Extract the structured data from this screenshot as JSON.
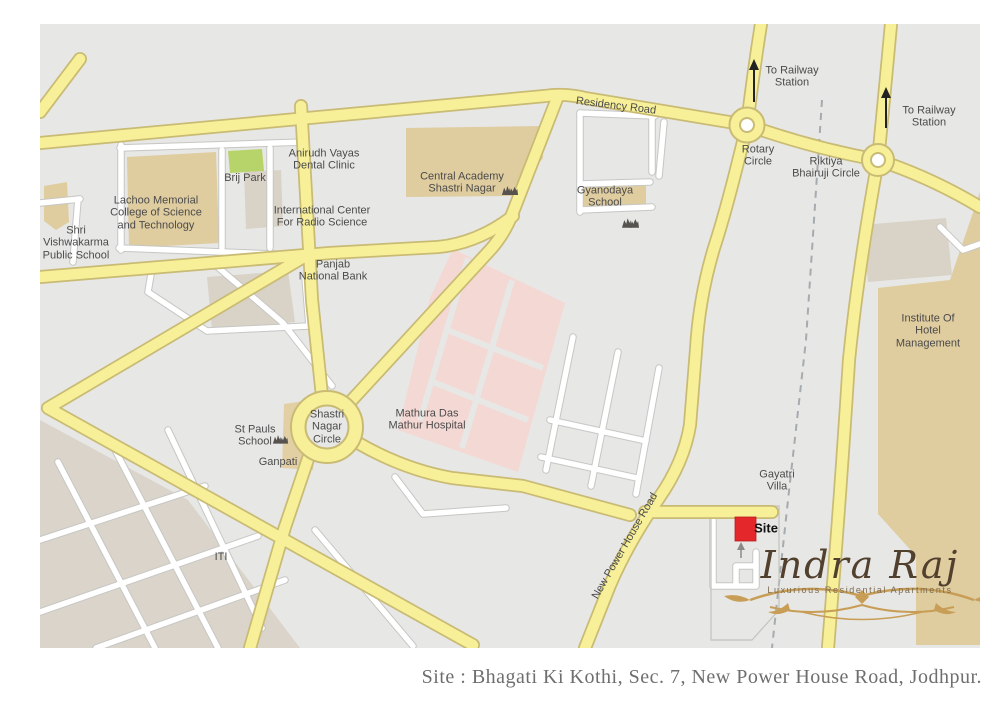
{
  "map": {
    "palette": {
      "background": "#e7e7e5",
      "road_yellow": "#f7f099",
      "road_yellow_casing": "#c9bb74",
      "road_white": "#ffffff",
      "road_white_casing": "#c6c6c3",
      "block_beige": "#dfcc9f",
      "block_taupe": "#d9d2c7",
      "block_green": "#b7d46b",
      "block_pink": "#f4d8d4",
      "railway_gray": "#a6abb0",
      "site_red": "#e4272b",
      "label_gray": "#4b4b4b",
      "logo_brown": "#52402e",
      "flourish_gold": "#c89d55"
    },
    "labels": {
      "residency_road": "Residency Road",
      "to_railway_1": "To Railway\nStation",
      "to_railway_2": "To Railway\nStation",
      "rotary_circle": "Rotary\nCircle",
      "riktiya_bhairuji": "Riktiya\nBhairuji Circle",
      "gyanodaya": "Gyanodaya\nSchool",
      "central_academy": "Central Academy\nShastri Nagar",
      "anirudh": "Anirudh Vayas\nDental Clinic",
      "brij_park": "Brij Park",
      "lachoo": "Lachoo Memorial\nCollege of Science\nand Technology",
      "shri_vishwakarma": "Shri\nVishwakarma\nPublic School",
      "intl_center": "International Center\nFor Radio Science",
      "panjab": "Panjab\nNational Bank",
      "ihm": "Institute Of Hotel\nManagement",
      "mathura": "Mathura Das\nMathur Hospital",
      "shastri_circle": "Shastri\nNagar\nCircle",
      "st_pauls": "St Pauls\nSchool",
      "ganpati": "Ganpati",
      "iti": "ITI",
      "gayatri": "Gayatri\nVilla",
      "nph_road": "New Power House Road",
      "site": "Site"
    },
    "logo": {
      "name": "Indra Raj",
      "tagline": "Luxurious Residential Apartments"
    },
    "caption": "Site : Bhagati Ki Kothi, Sec. 7, New Power House Road, Jodhpur."
  }
}
